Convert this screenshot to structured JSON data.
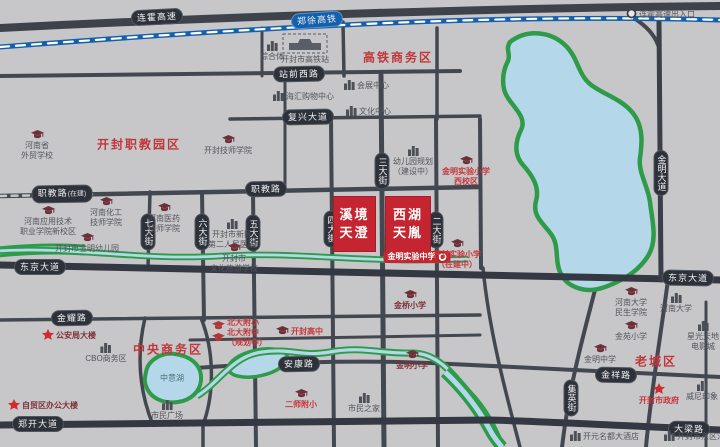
{
  "map": {
    "colors": {
      "background": "#c7c7c9",
      "road": "#43474f",
      "main_road": "#343842",
      "railway_blue": "#1460ac",
      "water_blue": "#b4d8e9",
      "green": "#2e9b49",
      "project_red": "#c52530",
      "district_red": "#c0373a"
    },
    "highway": {
      "label": "连霍高速",
      "x": 157,
      "y": 17,
      "rot": -3
    },
    "railway": {
      "label": "郑徐高铁",
      "x": 317,
      "y": 20,
      "rot": -4
    },
    "road_labels": [
      {
        "n": "zhanqian-west-road-label",
        "text": "站前西路",
        "x": 299,
        "y": 74,
        "rot": -1
      },
      {
        "n": "fuxing-avenue-label",
        "text": "复兴大道",
        "x": 308,
        "y": 117,
        "rot": -1
      },
      {
        "n": "zhijiao-road-west-label",
        "text": "职教路",
        "suffix": "(在建)",
        "x": 62,
        "y": 194,
        "rot": -1
      },
      {
        "n": "zhijiao-road-label",
        "text": "职教路",
        "x": 266,
        "y": 189,
        "rot": -1
      },
      {
        "n": "dongjing-avenue-west-label",
        "text": "东京大道",
        "x": 40,
        "y": 267,
        "rot": 0
      },
      {
        "n": "dongjing-avenue-east-label",
        "text": "东京大道",
        "x": 688,
        "y": 278,
        "rot": 1
      },
      {
        "n": "jinyao-road-label",
        "text": "金耀路",
        "x": 72,
        "y": 318,
        "rot": -1
      },
      {
        "n": "ankang-road-label",
        "text": "安康路",
        "x": 299,
        "y": 364,
        "rot": -1
      },
      {
        "n": "jinxiang-road-label",
        "text": "金祥路",
        "x": 616,
        "y": 375,
        "rot": 1
      },
      {
        "n": "zhengkai-avenue-label",
        "text": "郑开大道",
        "x": 38,
        "y": 424,
        "rot": 0
      },
      {
        "n": "daliang-road-label",
        "text": "大梁路",
        "x": 689,
        "y": 429,
        "rot": 1
      },
      {
        "n": "qi-street-label",
        "text": "七大街",
        "x": 148,
        "y": 232,
        "vert": true
      },
      {
        "n": "liu-street-label",
        "text": "六大街",
        "x": 202,
        "y": 232,
        "vert": true
      },
      {
        "n": "wu-street-label",
        "text": "五大街",
        "x": 253,
        "y": 233,
        "vert": true
      },
      {
        "n": "si-street-label",
        "text": "四大街",
        "x": 331,
        "y": 229,
        "vert": true
      },
      {
        "n": "san-street-label",
        "text": "三大街",
        "x": 382,
        "y": 171,
        "vert": true
      },
      {
        "n": "er-street-label",
        "text": "二大街",
        "x": 436,
        "y": 230,
        "vert": true
      },
      {
        "n": "jinming-avenue-label",
        "text": "金明大道",
        "x": 661,
        "y": 173,
        "vert": true
      },
      {
        "n": "jiying-street-label",
        "text": "集英街",
        "x": 571,
        "y": 398,
        "vert": true
      }
    ],
    "districts": [
      {
        "n": "district-gaotie-cbd",
        "text": "高铁商务区",
        "x": 398,
        "y": 57
      },
      {
        "n": "district-zhijiao-park",
        "text": "开封职教园区",
        "x": 139,
        "y": 144
      },
      {
        "n": "district-central-cbd",
        "text": "中央商务区",
        "x": 168,
        "y": 349
      },
      {
        "n": "district-old-town",
        "text": "老城区",
        "x": 656,
        "y": 361
      }
    ],
    "projects": [
      {
        "n": "project-block-xijing-tiancheng",
        "lines": [
          "溪境",
          "天澄"
        ],
        "x": 333,
        "y": 196,
        "w": 43,
        "h": 56
      },
      {
        "n": "project-block-xihu-tianyin",
        "lines": [
          "西湖",
          "天胤"
        ],
        "x": 385,
        "y": 196,
        "w": 46,
        "h": 56
      }
    ],
    "banner": {
      "n": "jinming-experimental-middle-school-banner",
      "text": "金明实验中学",
      "x": 417,
      "y": 257
    },
    "lakes": [
      {
        "n": "zhongyi-lake-label",
        "text": "中意湖",
        "x": 172,
        "y": 378
      }
    ],
    "pois": [
      {
        "n": "henan-foreign-trade-school",
        "icon": "cap",
        "mode": "top",
        "x": 37,
        "y": 130,
        "cls": "gray",
        "lines": [
          "河南省",
          "外贸学校"
        ]
      },
      {
        "n": "henan-applied-tech-college",
        "icon": "cap",
        "mode": "top",
        "x": 48,
        "y": 206,
        "cls": "gray",
        "lines": [
          "河南应用技术",
          "职业学院新校区"
        ]
      },
      {
        "n": "henan-chemical-technician-college",
        "icon": "cap",
        "mode": "top",
        "x": 106,
        "y": 197,
        "cls": "gray",
        "lines": [
          "河南化工",
          "技师学院"
        ]
      },
      {
        "n": "jinming-kindergarten",
        "icon": "cap",
        "mode": "top",
        "x": 87,
        "y": 233,
        "cls": "gray",
        "lines": [
          "开封市金明幼儿园"
        ]
      },
      {
        "n": "henan-medical-technician-college",
        "icon": "cap",
        "mode": "top",
        "x": 164,
        "y": 203,
        "cls": "gray",
        "lines": [
          "河南医药",
          "技师学院"
        ]
      },
      {
        "n": "kaifeng-technician-college",
        "icon": "cap",
        "mode": "top",
        "x": 228,
        "y": 135,
        "cls": "gray",
        "lines": [
          "开封技师学院"
        ]
      },
      {
        "n": "second-peoples-hospital",
        "icon": "bldg",
        "mode": "top",
        "x": 232,
        "y": 219,
        "cls": "gray",
        "lines": [
          "开封市新区",
          "第二人民医院"
        ]
      },
      {
        "n": "culture-tourism-school",
        "icon": "cap",
        "mode": "top",
        "x": 234,
        "y": 243,
        "cls": "gray",
        "lines": [
          "开封市",
          "文化旅游学校"
        ]
      },
      {
        "n": "complex-poi",
        "icon": "bldg",
        "mode": "top",
        "x": 272,
        "y": 41,
        "cls": "gray",
        "lines": [
          "综合体"
        ]
      },
      {
        "n": "kaifeng-high-speed-rail-station",
        "icon": "station",
        "mode": "top",
        "x": 305,
        "y": 33,
        "cls": "gray",
        "lines": [
          "开封市高铁站"
        ]
      },
      {
        "n": "haihui-shopping-center",
        "icon": "bldg",
        "mode": "row",
        "x": 273,
        "y": 91,
        "cls": "gray",
        "lines": [
          "海汇购物中心"
        ]
      },
      {
        "n": "convention-center",
        "icon": "bldg",
        "mode": "row",
        "x": 344,
        "y": 80,
        "cls": "gray",
        "lines": [
          "会展中心"
        ]
      },
      {
        "n": "culture-center",
        "icon": "bldg",
        "mode": "row",
        "x": 346,
        "y": 106,
        "cls": "gray",
        "lines": [
          "文化中心"
        ]
      },
      {
        "n": "kindergarten-under-construction",
        "icon": "bldg",
        "mode": "top",
        "x": 413,
        "y": 146,
        "cls": "gray",
        "lines": [
          "幼儿园规划",
          "（建设中）"
        ]
      },
      {
        "n": "jinming-experimental-primary-west",
        "icon": "cap",
        "mode": "top",
        "x": 466,
        "y": 156,
        "cls": "red",
        "lines": [
          "金明实验小学",
          "西校区"
        ]
      },
      {
        "n": "kaifeng-experimental-primary",
        "icon": "cap",
        "mode": "top",
        "x": 457,
        "y": 239,
        "cls": "red",
        "lines": [
          "开封实验小学",
          "（在建中）"
        ]
      },
      {
        "n": "public-security-building",
        "icon": "star",
        "mode": "row",
        "x": 42,
        "y": 329,
        "cls": "maroon",
        "lines": [
          "公安局大楼"
        ]
      },
      {
        "n": "cbo-business-area",
        "icon": "bldg",
        "mode": "top",
        "x": 106,
        "y": 343,
        "cls": "gray",
        "lines": [
          "CBO商务区"
        ]
      },
      {
        "n": "citizen-square",
        "icon": "bldg",
        "mode": "top",
        "x": 167,
        "y": 400,
        "cls": "gray",
        "lines": [
          "市民广场"
        ]
      },
      {
        "n": "free-trade-office-building",
        "icon": "star",
        "mode": "row",
        "x": 8,
        "y": 399,
        "cls": "maroon",
        "lines": [
          "自贸区办公大楼"
        ]
      },
      {
        "n": "beida-affiliated-schools",
        "icon": "cap2",
        "mode": "row",
        "x": 212,
        "y": 317,
        "cls": "red",
        "lines": [
          "北大附小",
          "北大附中",
          "（规划中）"
        ]
      },
      {
        "n": "kaifeng-high-school",
        "icon": "cap",
        "mode": "row",
        "x": 276,
        "y": 326,
        "cls": "red",
        "lines": [
          "开封高中"
        ]
      },
      {
        "n": "ershi-affiliated-primary",
        "icon": "cap",
        "mode": "top",
        "x": 301,
        "y": 389,
        "cls": "red",
        "lines": [
          "二师附小"
        ]
      },
      {
        "n": "citizen-home",
        "icon": "bldg",
        "mode": "top",
        "x": 364,
        "y": 393,
        "cls": "gray",
        "lines": [
          "市民之家"
        ]
      },
      {
        "n": "jinqiao-primary-school",
        "icon": "cap",
        "mode": "top",
        "x": 410,
        "y": 290,
        "cls": "maroon",
        "lines": [
          "金桥小学"
        ]
      },
      {
        "n": "jinming-primary-school",
        "icon": "cap",
        "mode": "top",
        "x": 412,
        "y": 350,
        "cls": "maroon",
        "lines": [
          "金明小学"
        ]
      },
      {
        "n": "henan-university-minsheng-college",
        "icon": "cap",
        "mode": "top",
        "x": 631,
        "y": 287,
        "cls": "gray",
        "lines": [
          "河南大学",
          "民生学院"
        ]
      },
      {
        "n": "henan-university",
        "icon": "bldg",
        "mode": "top",
        "x": 676,
        "y": 293,
        "cls": "gray",
        "lines": [
          "河南大学"
        ]
      },
      {
        "n": "jinyuan-primary-school",
        "icon": "cap",
        "mode": "top",
        "x": 631,
        "y": 321,
        "cls": "gray",
        "lines": [
          "金苑小学"
        ]
      },
      {
        "n": "jinming-middle-school",
        "icon": "cap",
        "mode": "top",
        "x": 600,
        "y": 344,
        "cls": "gray",
        "lines": [
          "金明中学"
        ]
      },
      {
        "n": "kaifeng-city-government",
        "icon": "star",
        "mode": "top",
        "x": 659,
        "y": 383,
        "cls": "red",
        "lines": [
          "开封市政府"
        ]
      },
      {
        "n": "weini-impression",
        "icon": "bldg",
        "mode": "top",
        "x": 702,
        "y": 381,
        "cls": "gray",
        "lines": [
          "威尼印象"
        ]
      },
      {
        "n": "starlight-plaza",
        "icon": "bldg",
        "mode": "top",
        "x": 703,
        "y": 321,
        "cls": "gray",
        "lines": [
          "星光天地",
          "电影城"
        ]
      },
      {
        "n": "kaiyuan-mingdu-hotel",
        "icon": "bldg",
        "mode": "row",
        "x": 570,
        "y": 431,
        "cls": "gray",
        "lines": [
          "开元名都大酒店"
        ]
      },
      {
        "n": "east-district-court",
        "icon": "bldg",
        "mode": "row",
        "x": 664,
        "y": 431,
        "cls": "gray",
        "lines": [
          "开封市东区法院"
        ]
      },
      {
        "n": "lianhuo-expressway-exit",
        "icon": "circle",
        "mode": "row",
        "x": 626,
        "y": 8,
        "cls": "gray",
        "lines": [
          "连霍高速出入口"
        ]
      }
    ]
  }
}
